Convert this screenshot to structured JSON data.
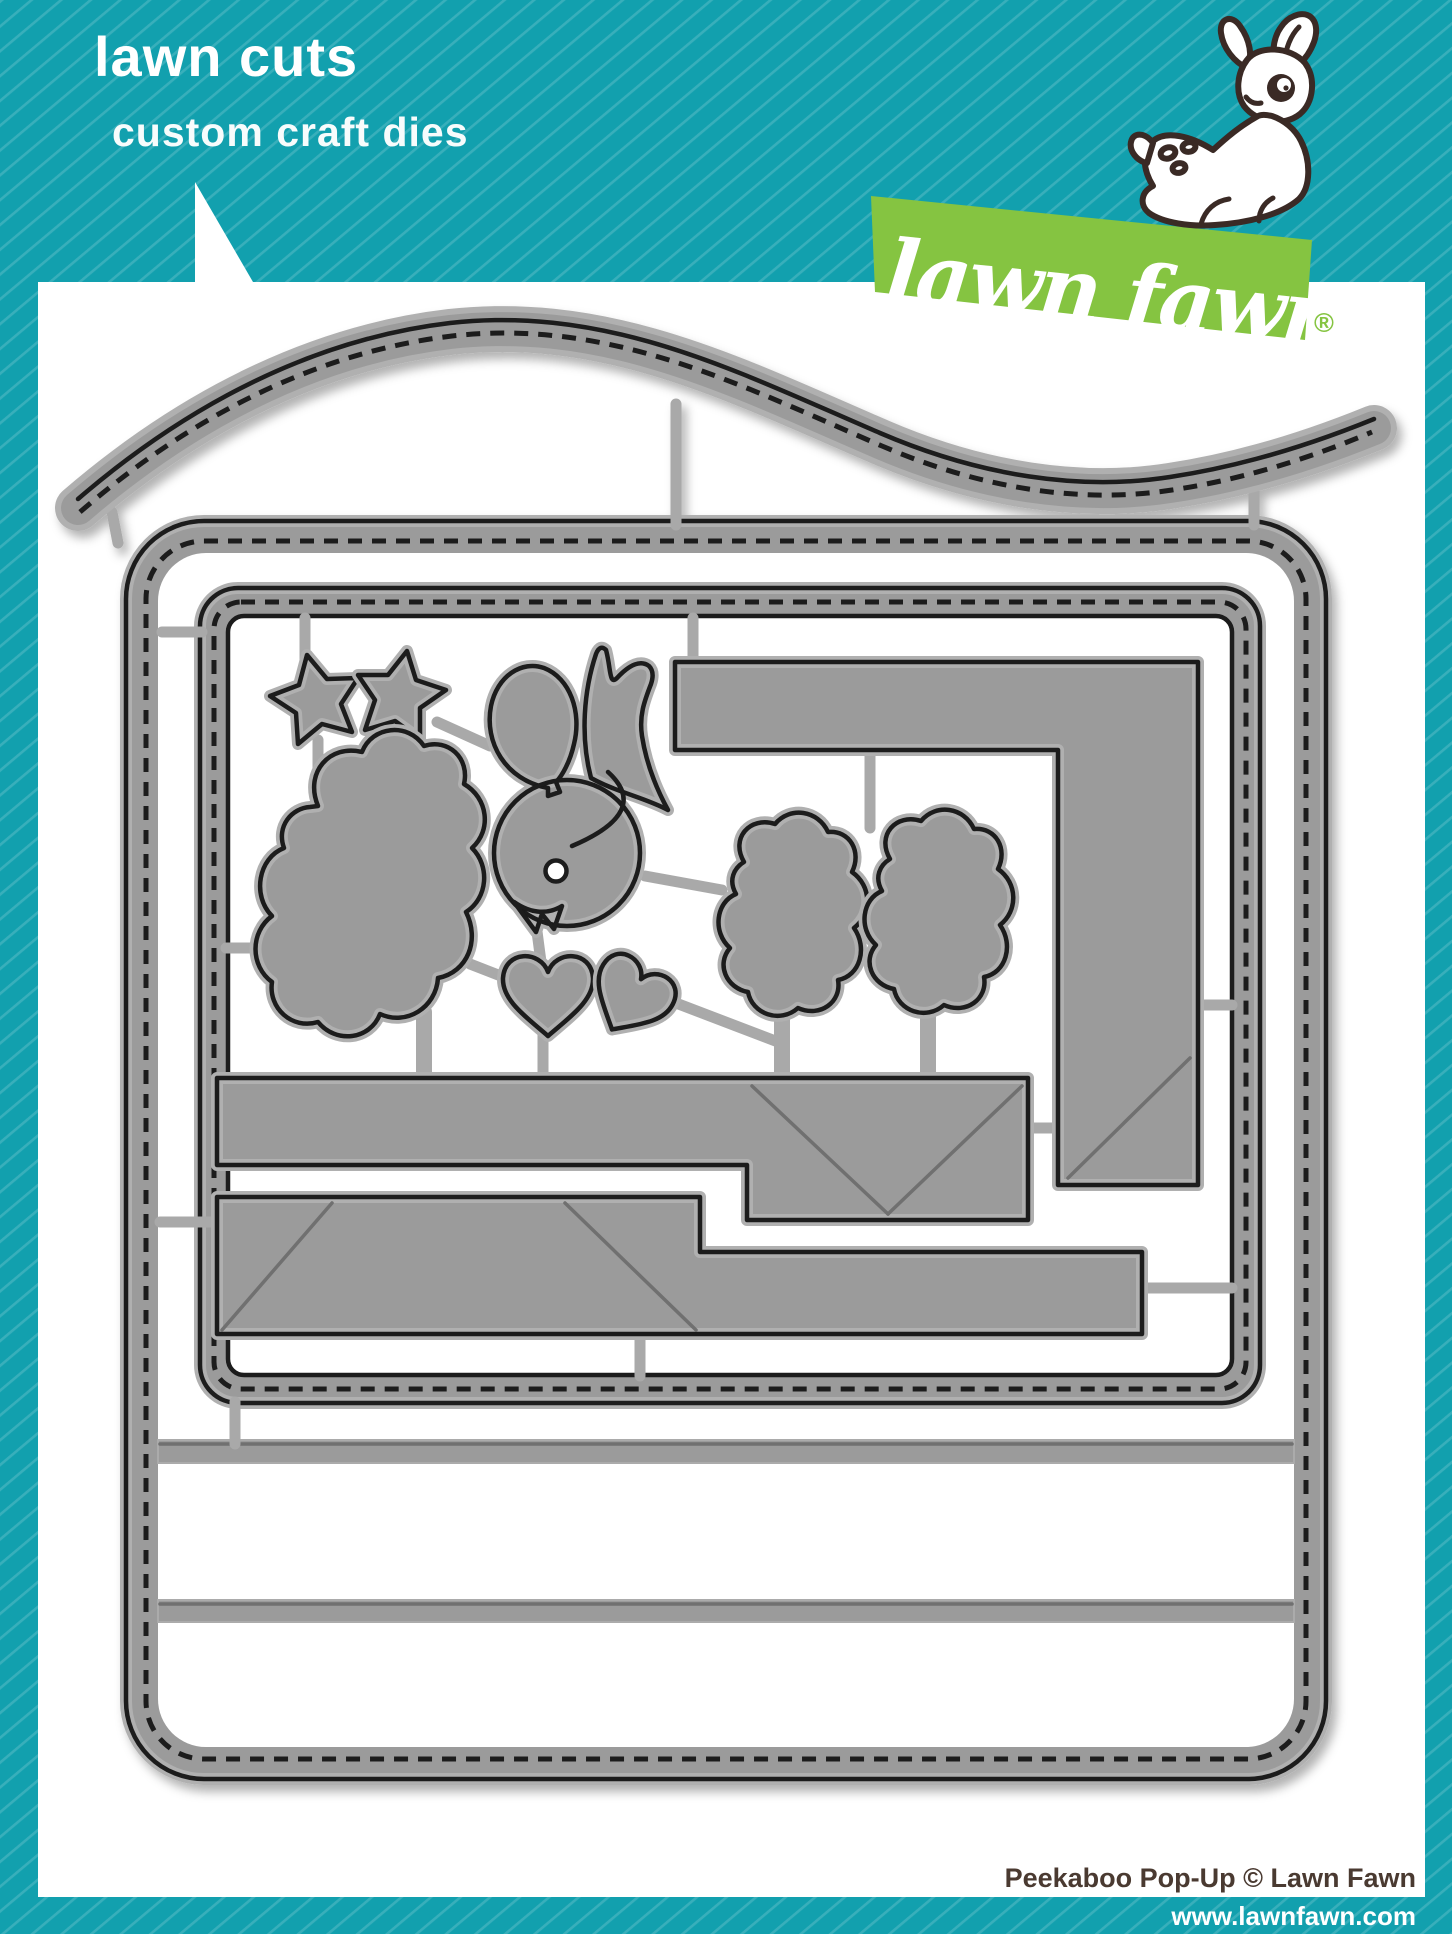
{
  "header": {
    "title": "lawn cuts",
    "subtitle": "custom craft dies"
  },
  "logo": {
    "script": "lawn fawn",
    "registered_mark": "®"
  },
  "footer": {
    "credit": "Peekaboo Pop-Up © Lawn Fawn",
    "website": "www.lawnfawn.com"
  },
  "colors": {
    "teal": "#12A0AE",
    "stripe": "rgba(255,255,255,0.16)",
    "white": "#FFFFFF",
    "green": "#85C441",
    "die_gray": "#9B9B9B",
    "die_halo": "#B0B0B0",
    "die_cut_line": "#1A1A1A",
    "text_brown": "#4A3A31"
  },
  "die_set": {
    "pieces": [
      {
        "name": "curved-stitched-border-die",
        "shape": "wavy strip with stitch holes"
      },
      {
        "name": "stitched-card-base-die",
        "shape": "large rounded stitched rectangle"
      },
      {
        "name": "stitched-window-frame-die",
        "shape": "inner stitched rectangle frame"
      },
      {
        "name": "star-die-left",
        "shape": "five point star"
      },
      {
        "name": "star-die-right",
        "shape": "five point star"
      },
      {
        "name": "cloud-tree-die",
        "shape": "large bumpy cloud"
      },
      {
        "name": "balloon-die",
        "shape": "balloon with knot"
      },
      {
        "name": "bird-die",
        "shape": "bird with tail feathers, eye and beak"
      },
      {
        "name": "heart-die-upright",
        "shape": "heart"
      },
      {
        "name": "heart-die-tilted",
        "shape": "tilted heart"
      },
      {
        "name": "bush-die-left",
        "shape": "bumpy bush"
      },
      {
        "name": "bush-die-right",
        "shape": "bumpy bush"
      },
      {
        "name": "corner-panel-die",
        "shape": "L-shaped panel with fold diagonal"
      },
      {
        "name": "step-panel-die-upper",
        "shape": "stepped bar with V fold lines"
      },
      {
        "name": "step-panel-die-lower",
        "shape": "stepped bar with fold diagonals"
      },
      {
        "name": "fold-score-strip-top",
        "shape": "thin horizontal strip"
      },
      {
        "name": "fold-score-strip-bottom",
        "shape": "thin horizontal strip"
      }
    ]
  }
}
